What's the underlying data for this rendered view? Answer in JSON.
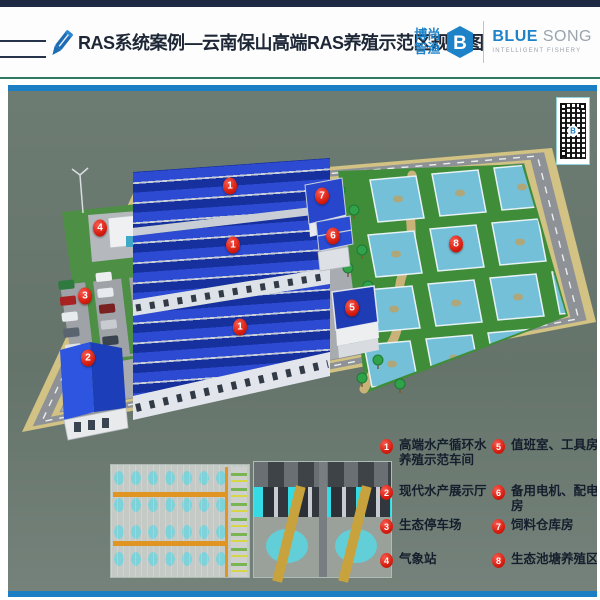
{
  "header": {
    "title": "RAS系统案例—云南保山高端RAS养殖示范区规划图",
    "logo": {
      "cn_top": "博尚",
      "cn_bottom": "智渔",
      "monogram": "B",
      "en_bold": "BLUE",
      "en_light": "SONG",
      "tagline": "INTELLIGENT FISHERY"
    }
  },
  "colors": {
    "accent_blue": "#1c7fc4",
    "marker_red": "#d81e10",
    "logo_blue": "#1e82c8",
    "header_navy": "#1e2a44",
    "teal_line": "#2f7a63",
    "scene_bg": "#6e7d74"
  },
  "scene": {
    "qr_monogram": "B",
    "markers": [
      {
        "num": "1",
        "x": 222,
        "y": 95
      },
      {
        "num": "1",
        "x": 225,
        "y": 154
      },
      {
        "num": "1",
        "x": 232,
        "y": 236
      },
      {
        "num": "2",
        "x": 80,
        "y": 267
      },
      {
        "num": "3",
        "x": 77,
        "y": 205
      },
      {
        "num": "4",
        "x": 92,
        "y": 137
      },
      {
        "num": "5",
        "x": 344,
        "y": 217
      },
      {
        "num": "6",
        "x": 325,
        "y": 145
      },
      {
        "num": "7",
        "x": 314,
        "y": 105
      },
      {
        "num": "8",
        "x": 448,
        "y": 153
      }
    ]
  },
  "legend": {
    "items": [
      {
        "num": "1",
        "label": "高端水产循环水养殖示范车间"
      },
      {
        "num": "2",
        "label": "现代水产展示厅"
      },
      {
        "num": "3",
        "label": "生态停车场"
      },
      {
        "num": "4",
        "label": "气象站"
      },
      {
        "num": "5",
        "label": "值班室、工具房"
      },
      {
        "num": "6",
        "label": "备用电机、配电房"
      },
      {
        "num": "7",
        "label": "饲料仓库房"
      },
      {
        "num": "8",
        "label": "生态池塘养殖区"
      }
    ]
  }
}
